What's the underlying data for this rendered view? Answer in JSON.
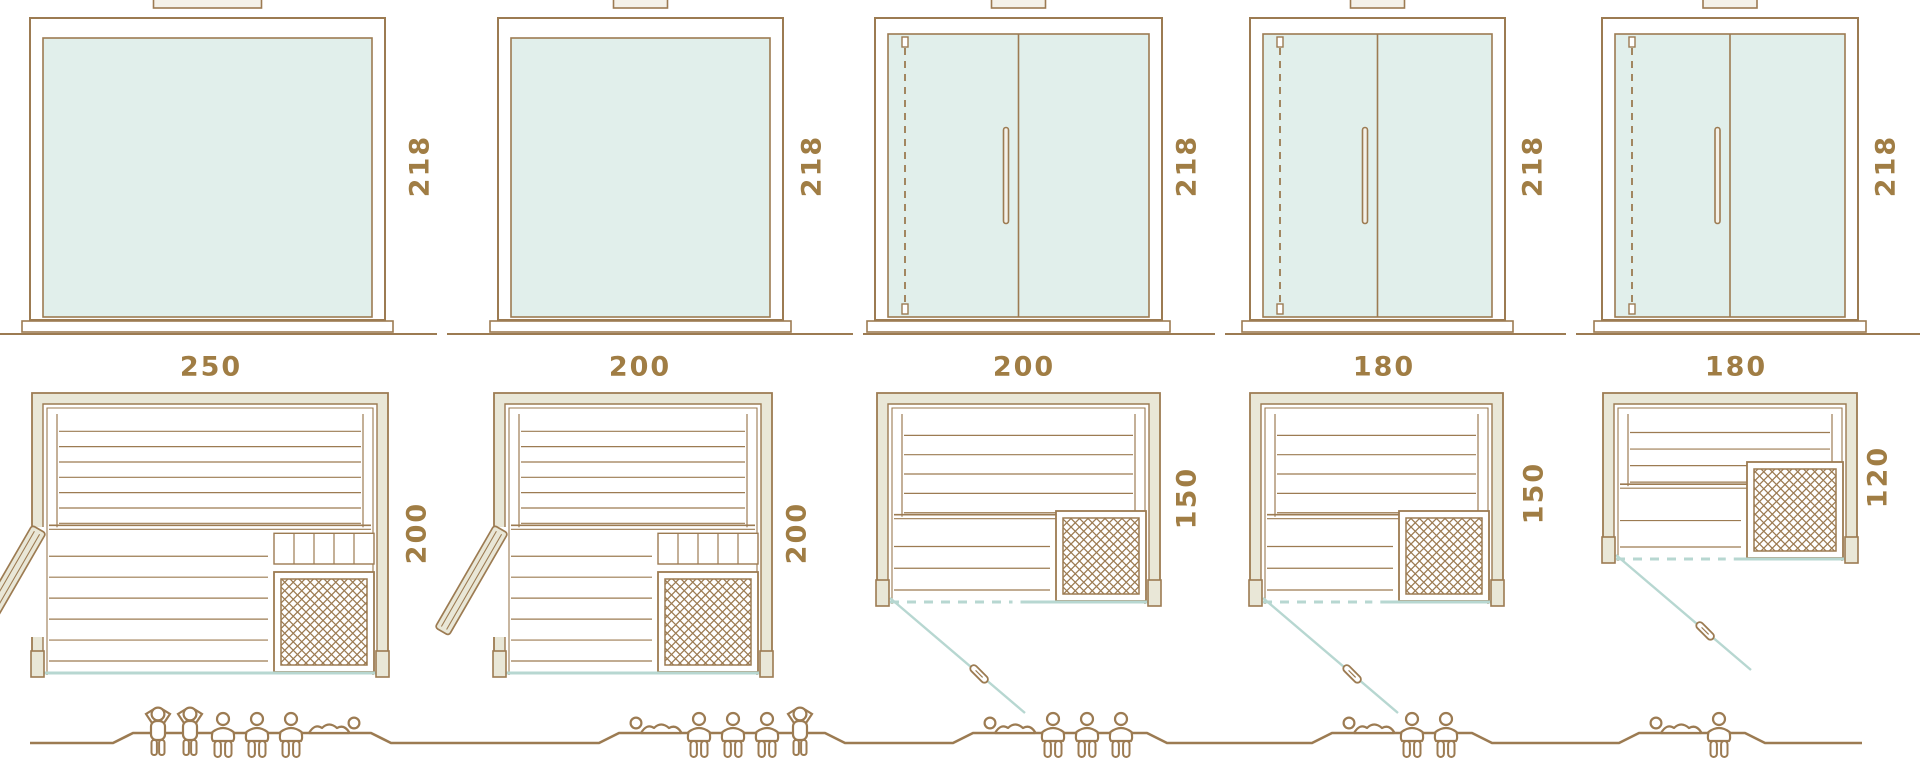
{
  "colors": {
    "line": "#9c7b52",
    "accent_text": "#a07d44",
    "glass_fill": "#e1efeb",
    "glass_line": "#b7d7d1",
    "wall_fill": "#e9e7d7",
    "cream": "#f4f1e8",
    "white": "#ffffff"
  },
  "units": [
    {
      "id": "model-250x200",
      "elevation": {
        "height_label": "218",
        "front_door": false
      },
      "plan": {
        "width_label": "250",
        "depth_label": "200",
        "door": "side-hinged",
        "heater": "bottom-right"
      },
      "capacity": {
        "total": 6,
        "figures": [
          "standing",
          "standing",
          "seated",
          "seated",
          "seated",
          "lying"
        ]
      }
    },
    {
      "id": "model-200x200",
      "elevation": {
        "height_label": "218",
        "front_door": false
      },
      "plan": {
        "width_label": "200",
        "depth_label": "200",
        "door": "side-hinged",
        "heater": "bottom-right"
      },
      "capacity": {
        "total": 5,
        "figures": [
          "lying",
          "seated",
          "seated",
          "seated",
          "standing"
        ]
      }
    },
    {
      "id": "model-200x150",
      "elevation": {
        "height_label": "218",
        "front_door": true
      },
      "plan": {
        "width_label": "200",
        "depth_label": "150",
        "door": "glass-front",
        "heater": "bottom-right"
      },
      "capacity": {
        "total": 4,
        "figures": [
          "lying",
          "seated",
          "seated",
          "seated"
        ]
      }
    },
    {
      "id": "model-180x150",
      "elevation": {
        "height_label": "218",
        "front_door": true
      },
      "plan": {
        "width_label": "180",
        "depth_label": "150",
        "door": "glass-front",
        "heater": "bottom-right"
      },
      "capacity": {
        "total": 3,
        "figures": [
          "lying",
          "seated",
          "seated"
        ]
      }
    },
    {
      "id": "model-180x120",
      "elevation": {
        "height_label": "218",
        "front_door": true
      },
      "plan": {
        "width_label": "180",
        "depth_label": "120",
        "door": "glass-front",
        "heater": "bottom-right"
      },
      "capacity": {
        "total": 2,
        "figures": [
          "lying",
          "seated"
        ]
      }
    }
  ]
}
